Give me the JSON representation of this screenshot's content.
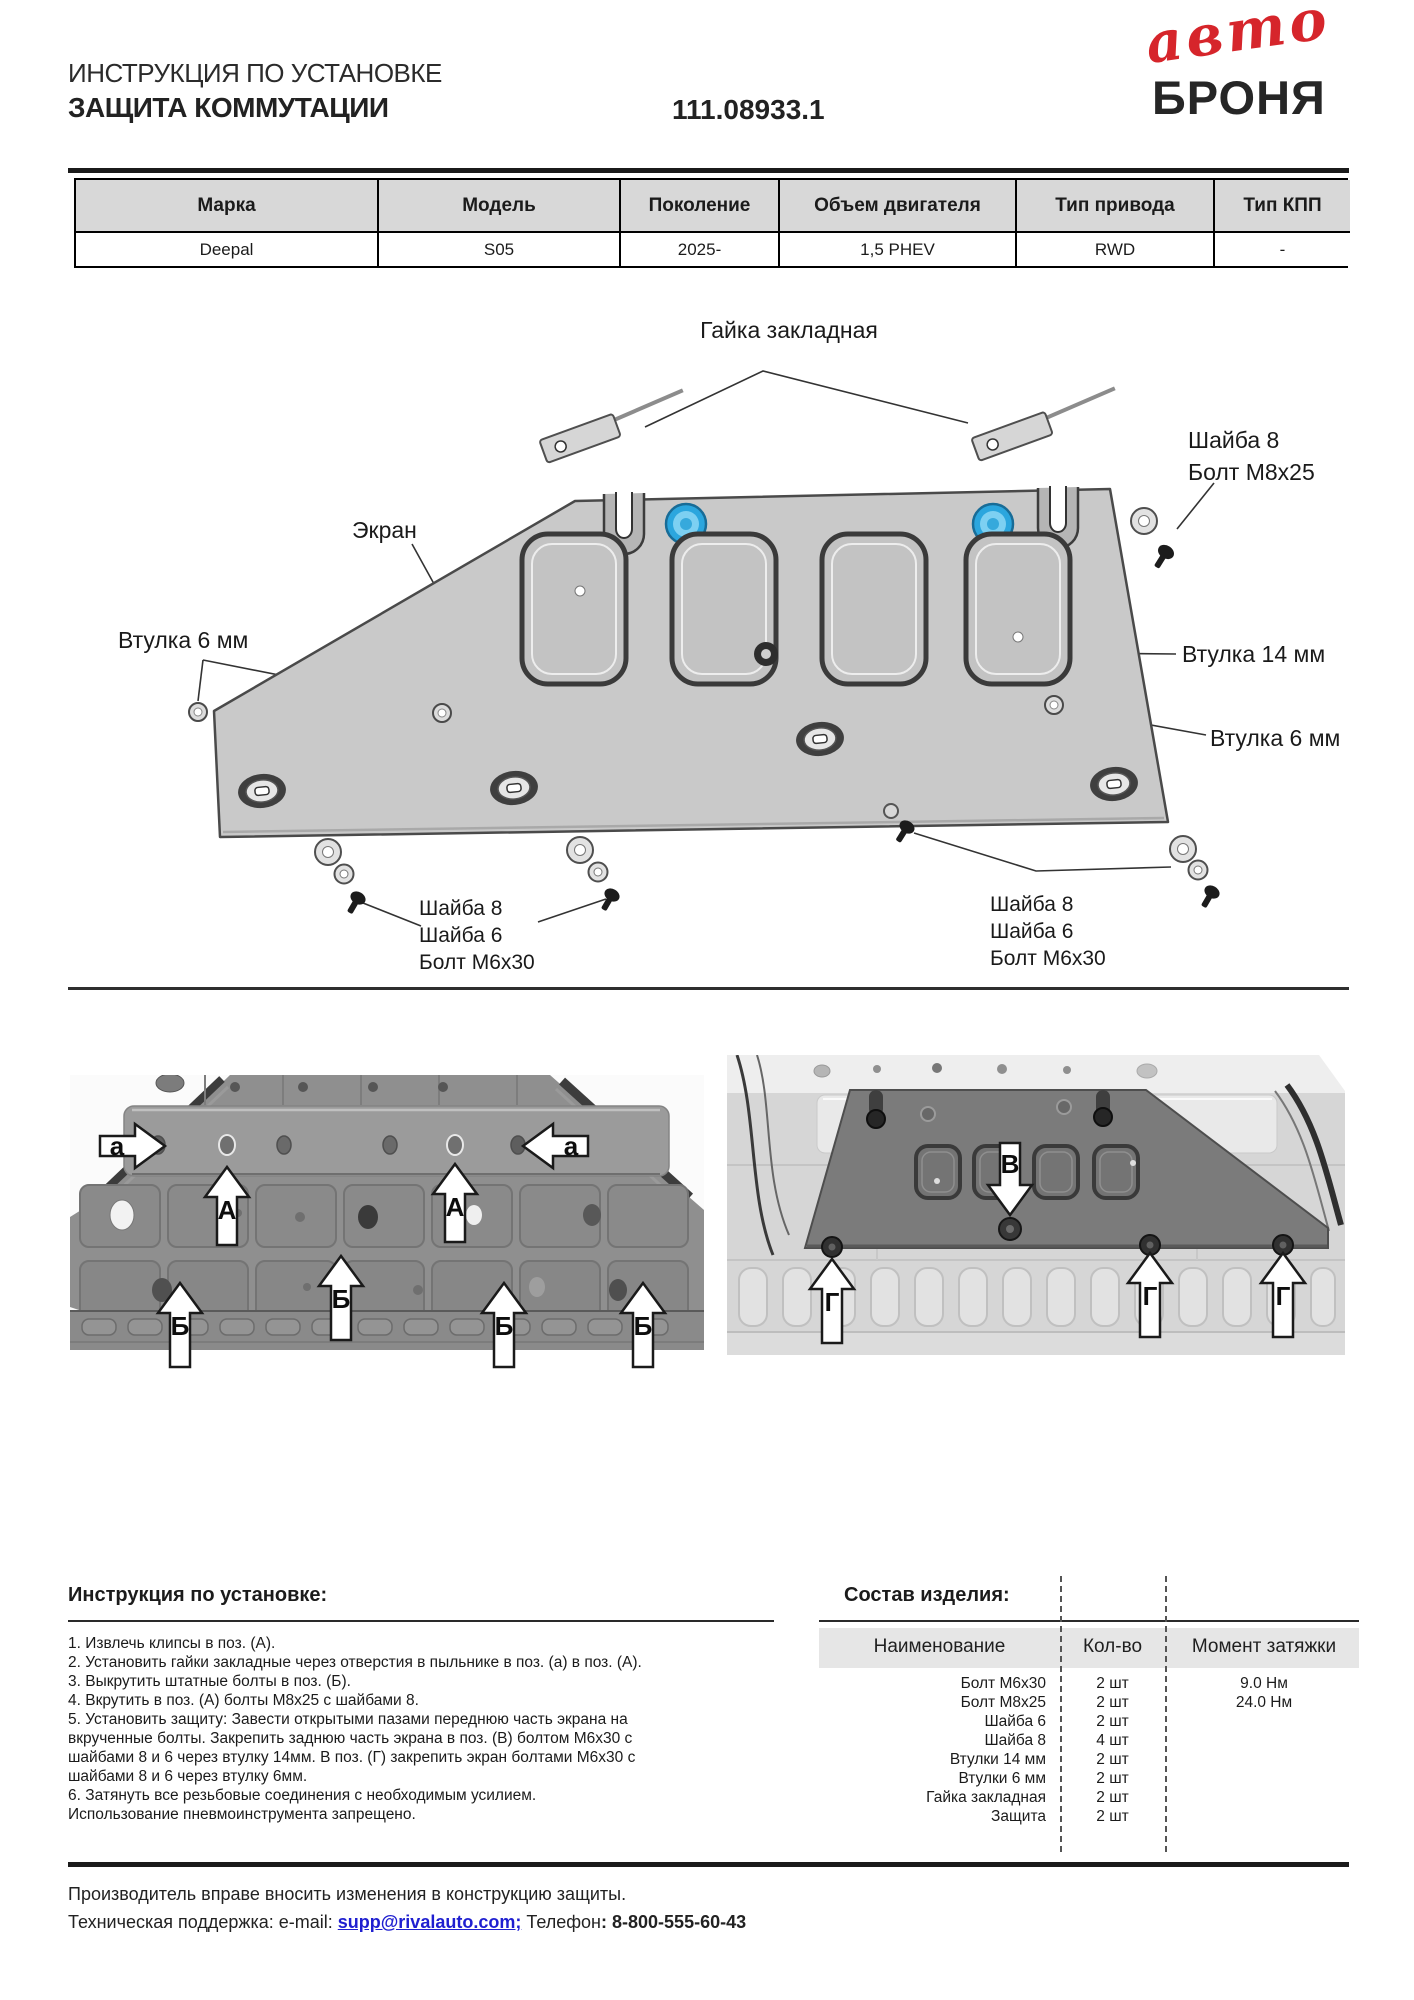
{
  "header": {
    "doc_type": "ИНСТРУКЦИЯ ПО УСТАНОВКЕ",
    "product": "ЗАЩИТА КОММУТАЦИИ",
    "part_number": "111.08933.1",
    "logo": {
      "top": "авто",
      "bottom": "БРОНЯ",
      "red": "#d6252b"
    }
  },
  "spec_table": {
    "columns": [
      {
        "header": "Марка",
        "value": "Deepal"
      },
      {
        "header": "Модель",
        "value": "S05"
      },
      {
        "header": "Поколение",
        "value": "2025-"
      },
      {
        "header": "Объем двигателя",
        "value": "1,5 PHEV"
      },
      {
        "header": "Тип привода",
        "value": "RWD"
      },
      {
        "header": "Тип КПП",
        "value": "-"
      }
    ]
  },
  "diagram": {
    "labels": {
      "nut_plate": "Гайка закладная",
      "washer8": "Шайба 8",
      "bolt_m8x25": "Болт М8х25",
      "screen": "Экран",
      "bush6_left": "Втулка 6 мм",
      "bush14": "Втулка 14 мм",
      "bush6_right": "Втулка 6 мм",
      "washer6": "Шайба 6",
      "bolt_m6x30": "Болт М6х30"
    }
  },
  "photos": {
    "left": {
      "marker_a": "а",
      "marker_A": "А",
      "marker_B": "Б"
    },
    "right": {
      "marker_V": "В",
      "marker_G": "Г"
    }
  },
  "instructions": {
    "title": "Инструкция по установке:",
    "lines": [
      "1. Извлечь клипсы в поз. (А).",
      "2. Установить гайки закладные через отверстия в пыльнике в поз. (а) в поз. (А).",
      "3. Выкрутить штатные болты в поз. (Б).",
      "4. Вкрутить в поз. (А) болты М8х25 с шайбами 8.",
      "5. Установить защиту: Завести открытыми пазами переднюю часть экрана на",
      "вкрученные болты. Закрепить заднюю часть экрана в поз. (В) болтом М6х30 с",
      "шайбами 8 и 6 через втулку 14мм. В поз. (Г) закрепить экран болтами М6х30 с",
      "шайбами 8 и 6 через втулку 6мм.",
      "6. Затянуть все резьбовые соединения с необходимым усилием.",
      "Использование пневмоинструмента запрещено."
    ]
  },
  "parts": {
    "title": "Состав изделия:",
    "headers": [
      "Наименование",
      "Кол-во",
      "Момент затяжки"
    ],
    "rows": [
      {
        "name": "Болт М6х30",
        "qty": "2 шт",
        "torque": "9.0 Нм"
      },
      {
        "name": "Болт М8х25",
        "qty": "2 шт",
        "torque": "24.0 Нм"
      },
      {
        "name": "Шайба 6",
        "qty": "2 шт",
        "torque": ""
      },
      {
        "name": "Шайба 8",
        "qty": "4 шт",
        "torque": ""
      },
      {
        "name": "Втулки 14 мм",
        "qty": "2 шт",
        "torque": ""
      },
      {
        "name": "Втулки 6 мм",
        "qty": "2 шт",
        "torque": ""
      },
      {
        "name": "Гайка закладная",
        "qty": "2 шт",
        "torque": ""
      },
      {
        "name": "Защита",
        "qty": "2 шт",
        "torque": ""
      }
    ]
  },
  "footer": {
    "note": "Производитель вправе вносить изменения в конструкцию защиты.",
    "support_prefix": "Техническая поддержка:  e-mail: ",
    "email": "supp@rivalauto.com;",
    "phone_label": " Телефон",
    "phone": ": 8-800-555-60-43"
  }
}
